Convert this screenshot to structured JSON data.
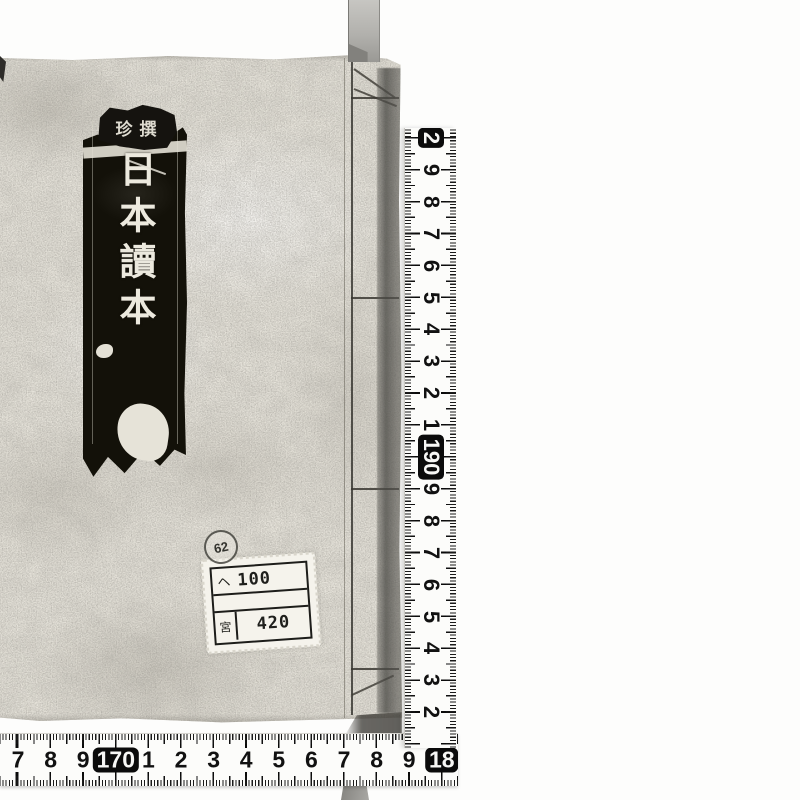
{
  "book": {
    "title_slip": {
      "header": "珍撰",
      "title": "日本讀本"
    },
    "call_label": {
      "rows": [
        {
          "left": "ヘ",
          "value": "100"
        },
        {
          "left": "",
          "value": ""
        },
        {
          "left": "宮",
          "value": "420"
        }
      ],
      "stamp": "62"
    }
  },
  "rulers": {
    "vertical": {
      "labels": [
        {
          "text": "2",
          "boxed": true
        },
        {
          "text": "9"
        },
        {
          "text": "8"
        },
        {
          "text": "7"
        },
        {
          "text": "6"
        },
        {
          "text": "5"
        },
        {
          "text": "4"
        },
        {
          "text": "3"
        },
        {
          "text": "2"
        },
        {
          "text": "1"
        },
        {
          "text": "190",
          "boxed": true
        },
        {
          "text": "9"
        },
        {
          "text": "8"
        },
        {
          "text": "7"
        },
        {
          "text": "6"
        },
        {
          "text": "5"
        },
        {
          "text": "4"
        },
        {
          "text": "3"
        },
        {
          "text": "2"
        }
      ]
    },
    "horizontal": {
      "labels": [
        {
          "text": "7"
        },
        {
          "text": "8"
        },
        {
          "text": "9"
        },
        {
          "text": "170",
          "boxed": true
        },
        {
          "text": "1"
        },
        {
          "text": "2"
        },
        {
          "text": "3"
        },
        {
          "text": "4"
        },
        {
          "text": "5"
        },
        {
          "text": "6"
        },
        {
          "text": "7"
        },
        {
          "text": "8"
        },
        {
          "text": "9"
        },
        {
          "text": "18",
          "boxed": true
        }
      ]
    }
  },
  "colors": {
    "cover": "#e8e5dc",
    "slip_black": "#131109",
    "ruler_paper": "#fcfcfa",
    "ink": "#111111"
  }
}
